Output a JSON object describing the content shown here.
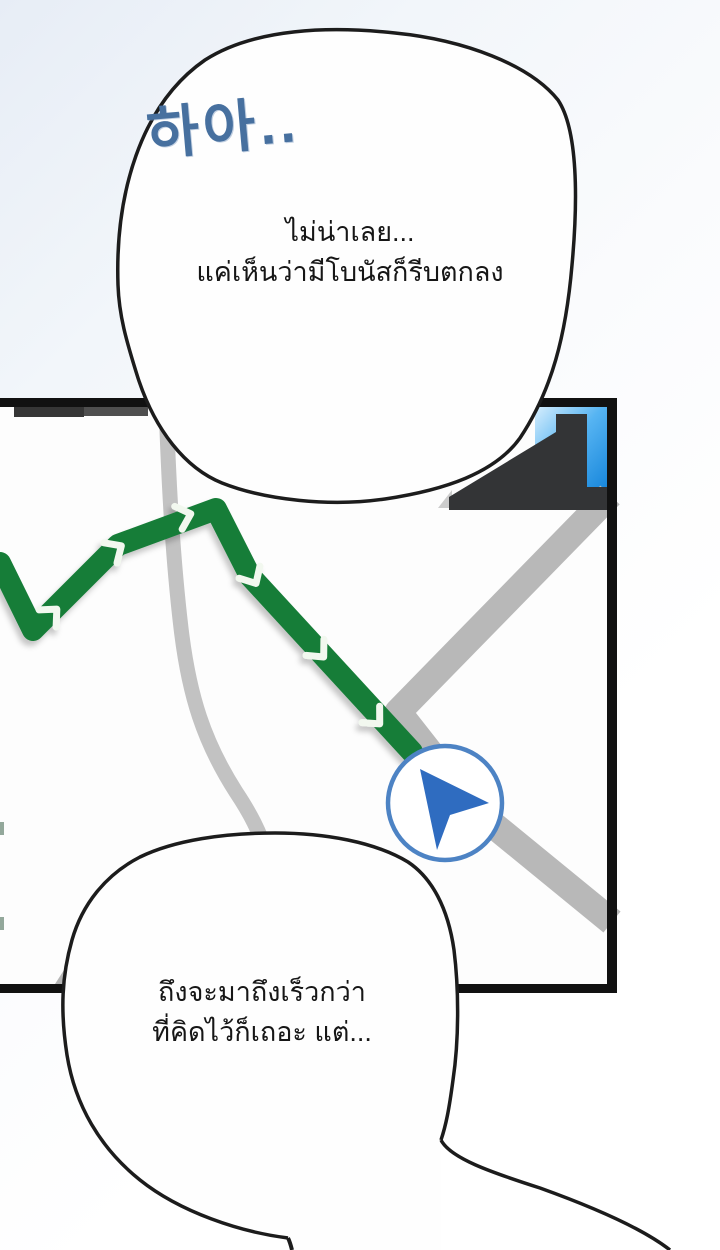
{
  "panel": {
    "type": "webtoon-navigation-map-panel",
    "bubbles": {
      "top": {
        "sfx": "하아..",
        "lines": [
          "ไม่น่าเลย...",
          "แค่เห็นว่ามีโบนัสก็รีบตกลง"
        ]
      },
      "bottom": {
        "lines": [
          "ถึงจะมาถึงเร็วกว่า",
          "ที่คิดไว้ก็เถอะ แต่..."
        ]
      }
    },
    "map": {
      "marker_icon": "navigation-arrow-icon",
      "route_color": "#177d38",
      "route_chevron_color": "#f2f8ef",
      "road_color": "#bcbcbc",
      "marker_ring_color": "#4d83c4",
      "marker_arrow_color": "#2f6cc0",
      "building_color": "#333436",
      "building_glass_color": "#1b8de4",
      "map_border_color": "#111111",
      "bubble_fill_color": "#ffffff",
      "bubble_outline_color": "#1c1c1c",
      "sfx_color": "#47709f"
    }
  }
}
